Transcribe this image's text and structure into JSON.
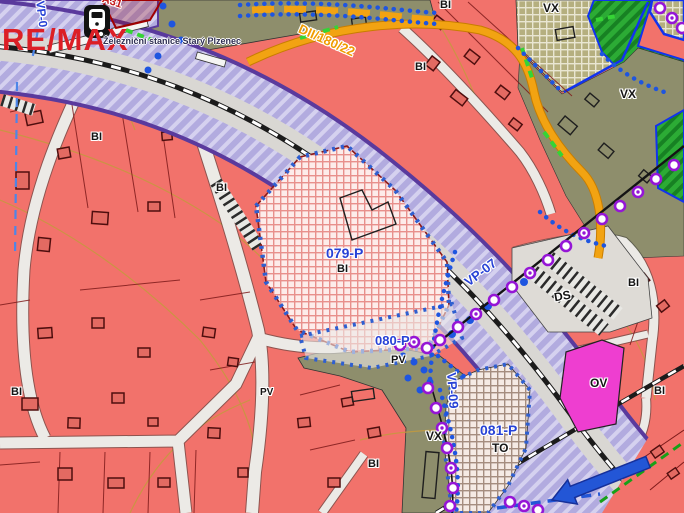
{
  "map": {
    "watermark": "RE/MAX",
    "station": {
      "name": "Železniční stanice Starý Plzenec",
      "icon": "train-station-icon"
    },
    "road_code": "DII/180/22",
    "plots": [
      {
        "id": "079-P",
        "use": "BI"
      },
      {
        "id": "080-P",
        "use": "PV"
      },
      {
        "id": "081-P",
        "use": "TO"
      }
    ],
    "public_spaces": [
      "VP-0",
      "VP-07",
      "VP-09"
    ],
    "zone_codes": [
      "BI",
      "VX",
      "PV",
      "TO",
      "DS",
      "OV"
    ],
    "colors": {
      "residential_bi": "#f2726b",
      "production_vx": "#8e8e6c",
      "corridor_violet": "#b2abdf",
      "corridor_edge": "#5a3a9d",
      "plot_label_blue": "#2742d6",
      "road_orange": "#f2a312",
      "civic_ov_magenta": "#ee3ed0",
      "greenery": "#2cab35",
      "marker_purple": "#9516d6",
      "boundary_dot_blue": "#1e55e0",
      "remax_red": "#dc1f26"
    }
  },
  "labels": [
    {
      "name": "remax-watermark",
      "text": "RE/MAX"
    },
    {
      "name": "station-name",
      "text": "Železniční stanice Starý Plzenec"
    },
    {
      "name": "road-code",
      "text": "DII/180/22"
    },
    {
      "name": "vp0-corridor",
      "text": "VP-0"
    },
    {
      "name": "a31-monument",
      "text": "A31"
    },
    {
      "name": "vx-zone-top",
      "text": "VX"
    },
    {
      "name": "vx-zone-right",
      "text": "VX"
    },
    {
      "name": "vx-zone-bottom",
      "text": "VX"
    },
    {
      "name": "bi-zone-top",
      "text": "BI"
    },
    {
      "name": "bi-zone-topright",
      "text": "BI"
    },
    {
      "name": "bi-zone-left",
      "text": "BI"
    },
    {
      "name": "bi-zone-center",
      "text": "BI"
    },
    {
      "name": "bi-zone-right",
      "text": "BI"
    },
    {
      "name": "bi-zone-farright",
      "text": "BI"
    },
    {
      "name": "bi-zone-bottomleft",
      "text": "BI"
    },
    {
      "name": "bi-zone-bottomcenter",
      "text": "BI"
    },
    {
      "name": "plot-079-id",
      "text": "079-P"
    },
    {
      "name": "plot-079-use",
      "text": "BI"
    },
    {
      "name": "plot-080-id",
      "text": "080-P"
    },
    {
      "name": "plot-080-use",
      "text": "PV"
    },
    {
      "name": "pv-street",
      "text": "PV"
    },
    {
      "name": "vp07-corridor",
      "text": "VP-07"
    },
    {
      "name": "vp09-corridor",
      "text": "VP-09"
    },
    {
      "name": "plot-081-id",
      "text": "081-P"
    },
    {
      "name": "plot-081-use",
      "text": "TO"
    },
    {
      "name": "ds-zone",
      "text": "DS"
    },
    {
      "name": "ov-zone",
      "text": "OV"
    }
  ]
}
